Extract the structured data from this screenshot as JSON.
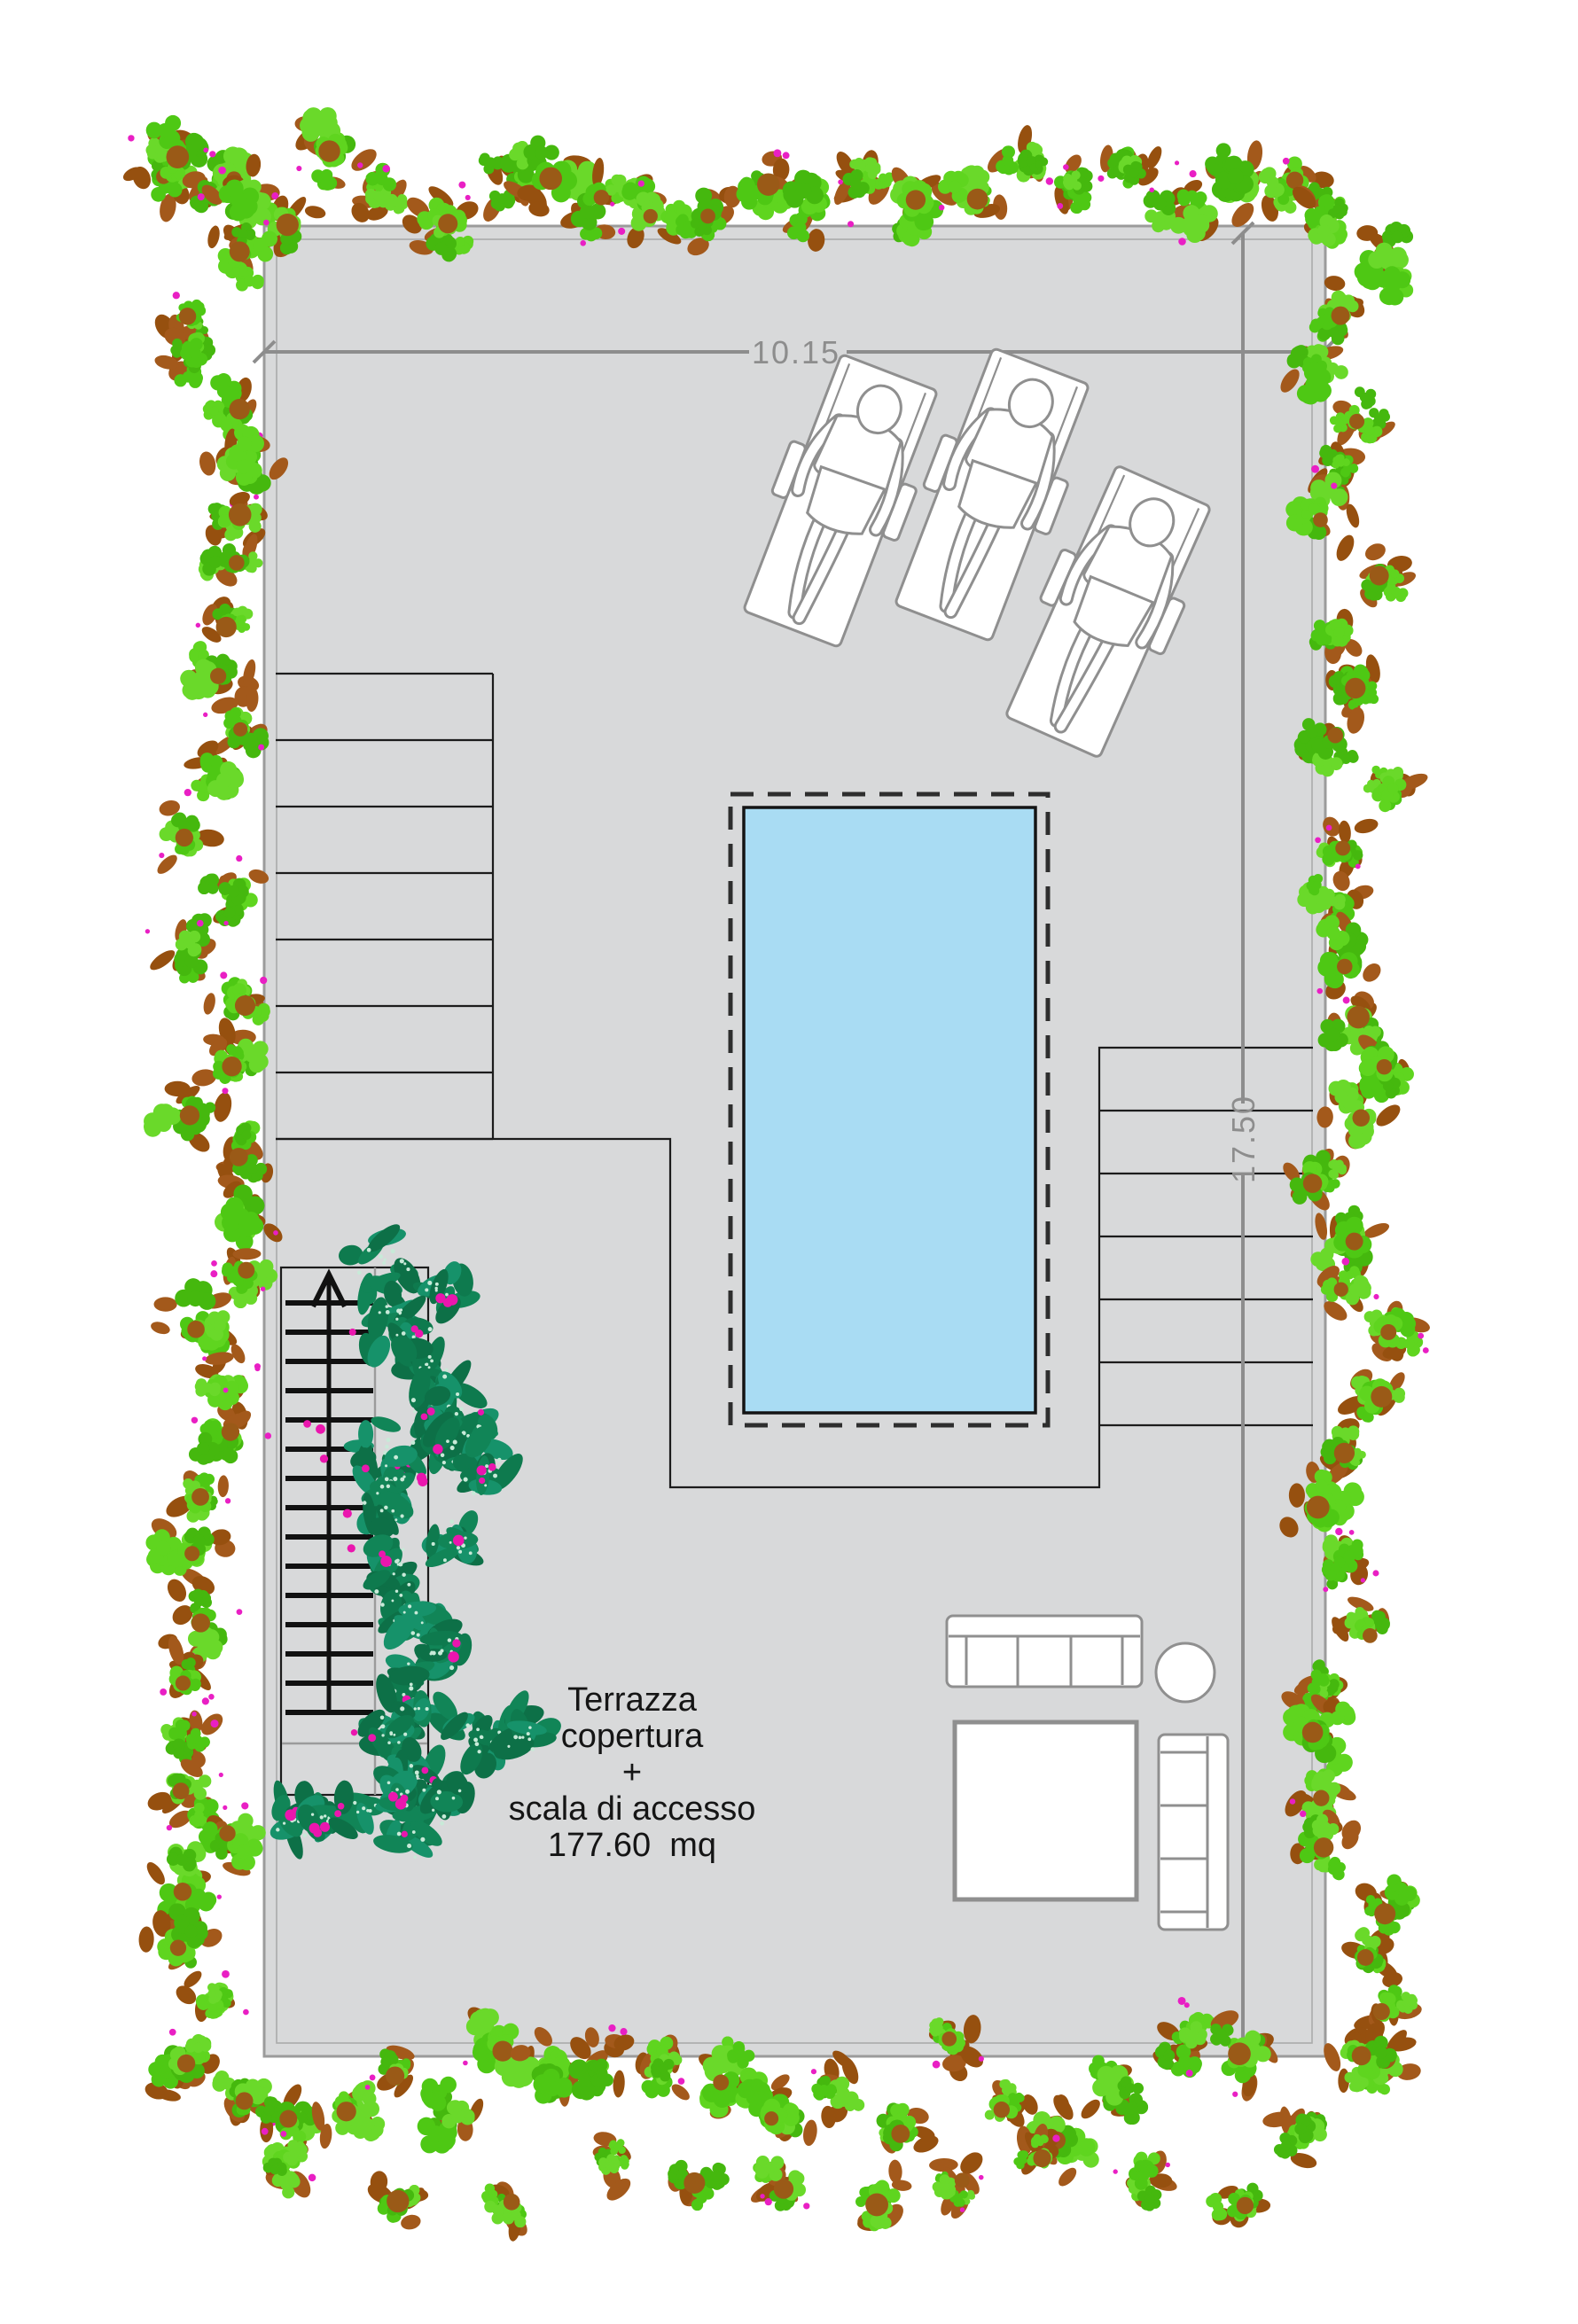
{
  "dimensions": {
    "width_label": "10.15",
    "height_label": "17.50"
  },
  "caption": {
    "lines": [
      "Terrazza",
      "copertura",
      "+",
      "scala di accesso",
      "177.60  mq"
    ]
  },
  "colors": {
    "floor": "#d8d9da",
    "wall": "#9b9b9b",
    "outline": "#1c1c1c",
    "dim": "#8d8d8d",
    "pool": "#a9dcf3",
    "pooledge": "#141414",
    "furn": "#8f8f8f",
    "tread": "#111111",
    "text": "#151515",
    "hedge_greens": [
      "#4ec814",
      "#5fd51f",
      "#45b80e",
      "#6ad92a"
    ],
    "hedge_browns": [
      "#a3591b",
      "#96500f"
    ],
    "hedge_center": "#9a5a17",
    "accent_magenta": "#e91fc4",
    "vine_greens": [
      "#118557",
      "#0e7a4e",
      "#16926a",
      "#0d7047"
    ],
    "vine_speckle": "#c8ead8",
    "vine_flower": "#ea16ae"
  }
}
